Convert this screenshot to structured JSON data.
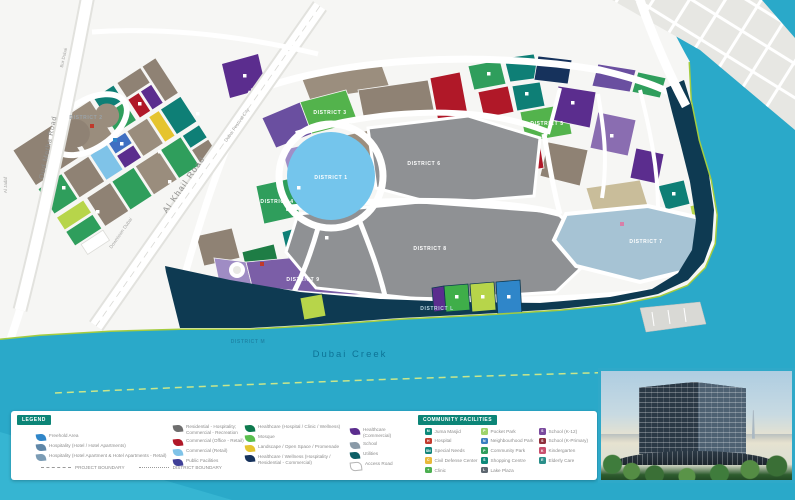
{
  "map": {
    "palette": {
      "water": "#2aa9c9",
      "shoreline_green": "#a4cc3f",
      "waterfront_band_navy": "#0e3a52",
      "district_gray": "#8f9194",
      "lake_blue": "#74c5ec",
      "accent_teal": "#0c8577"
    },
    "roads": {
      "oud_metha": "Oud Metha Road",
      "bur_dubai": "Bur Dubai",
      "al_jadaf": "Al Jadaf",
      "al_khail": "Al Khail Road",
      "downtown": "Downtown Dubai",
      "festival_city": "Dubai Festival City"
    },
    "water_label": "Dubai Creek",
    "districts": [
      {
        "label": "DISTRICT 1",
        "x": 331,
        "y": 179,
        "color": "#ffffff"
      },
      {
        "label": "DISTRICT 2",
        "x": 86,
        "y": 119,
        "color": "#9aa3a8"
      },
      {
        "label": "DISTRICT 3",
        "x": 330,
        "y": 114,
        "color": "#ffffff"
      },
      {
        "label": "DISTRICT 4",
        "x": 277,
        "y": 203,
        "color": "#ffffff"
      },
      {
        "label": "DISTRICT 5",
        "x": 547,
        "y": 125,
        "color": "#ffffff"
      },
      {
        "label": "DISTRICT 6",
        "x": 424,
        "y": 165,
        "color": "#ffffff"
      },
      {
        "label": "DISTRICT 7",
        "x": 646,
        "y": 243,
        "color": "#ffffff"
      },
      {
        "label": "DISTRICT 8",
        "x": 430,
        "y": 250,
        "color": "#ffffff"
      },
      {
        "label": "DISTRICT 9",
        "x": 303,
        "y": 281,
        "color": "#ffffff"
      },
      {
        "label": "DISTRICT L",
        "x": 437,
        "y": 310,
        "color": "#bcd8e2"
      },
      {
        "label": "DISTRICT M",
        "x": 248,
        "y": 343,
        "color": "#1f87a8"
      }
    ]
  },
  "legend": {
    "title": "LEGEND",
    "columns": [
      [
        {
          "label": "Freehold Area",
          "color": "#2f86c9"
        },
        {
          "label": "Hospitality (Hotel / Hotel Apartments)",
          "color": "#5f87a8"
        },
        {
          "label": "Hospitality (Hotel Apartment & Hotel Apartments - Retail)",
          "color": "#7b9cb5"
        }
      ],
      [
        {
          "label": "Residential - Hospitality; Commercial - Recreation",
          "color": "#6e6e6e"
        },
        {
          "label": "Commercial (Office - Retail)",
          "color": "#b01828"
        },
        {
          "label": "Commercial (Retail)",
          "color": "#7fc3e8"
        },
        {
          "label": "Public Facilities",
          "color": "#3f3f97"
        }
      ],
      [
        {
          "label": "Healthcare (Hospital / Clinic / Wellness)",
          "color": "#0e7a4e"
        },
        {
          "label": "Mosque",
          "color": "#5abf4e"
        },
        {
          "label": "Landscape / Open Space / Promenade",
          "color": "#e5c42e"
        },
        {
          "label": "Healthcare / Wellness (Hospitality / Residential - Commercial)",
          "color": "#16325c"
        }
      ],
      [
        {
          "label": "Healthcare (Commercial)",
          "color": "#5b2d8e"
        },
        {
          "label": "School",
          "color": "#8a9aa8"
        },
        {
          "label": "Utilities",
          "color": "#0d5f66"
        },
        {
          "label": "Access Road",
          "color": "#ffffff"
        }
      ]
    ],
    "boundaries": [
      {
        "label": "PROJECT BOUNDARY",
        "style": "dash"
      },
      {
        "label": "DISTRICT BOUNDARY",
        "style": "dot"
      }
    ]
  },
  "facilities": {
    "title": "COMMUNITY FACILITIES",
    "columns": [
      [
        {
          "label": "Juma Masjid",
          "color": "#0d8a7a",
          "glyph": "M"
        },
        {
          "label": "Hospital",
          "color": "#c23b2e",
          "glyph": "H"
        },
        {
          "label": "Special Needs",
          "color": "#13857b",
          "glyph": "SN"
        },
        {
          "label": "Civil Defense Center",
          "color": "#e8b93a",
          "glyph": "C"
        },
        {
          "label": "Clinic",
          "color": "#4caf50",
          "glyph": "+"
        }
      ],
      [
        {
          "label": "Pocket Park",
          "color": "#9fd36b",
          "glyph": "P"
        },
        {
          "label": "Neighbourhood Park",
          "color": "#3a7fc1",
          "glyph": "N"
        },
        {
          "label": "Community Park",
          "color": "#2f9e5c",
          "glyph": "P"
        },
        {
          "label": "Shopping Centre",
          "color": "#0d8a7a",
          "glyph": "S"
        },
        {
          "label": "Lake Plaza",
          "color": "#5d6770",
          "glyph": "L"
        }
      ],
      [
        {
          "label": "School (K-12)",
          "color": "#7a4a9e",
          "glyph": "S"
        },
        {
          "label": "School (K-Primary)",
          "color": "#8e2f3c",
          "glyph": "S"
        },
        {
          "label": "Kindergarten",
          "color": "#c94f6d",
          "glyph": "K"
        },
        {
          "label": "Elderly Care",
          "color": "#2a8f8a",
          "glyph": "E"
        }
      ]
    ]
  }
}
